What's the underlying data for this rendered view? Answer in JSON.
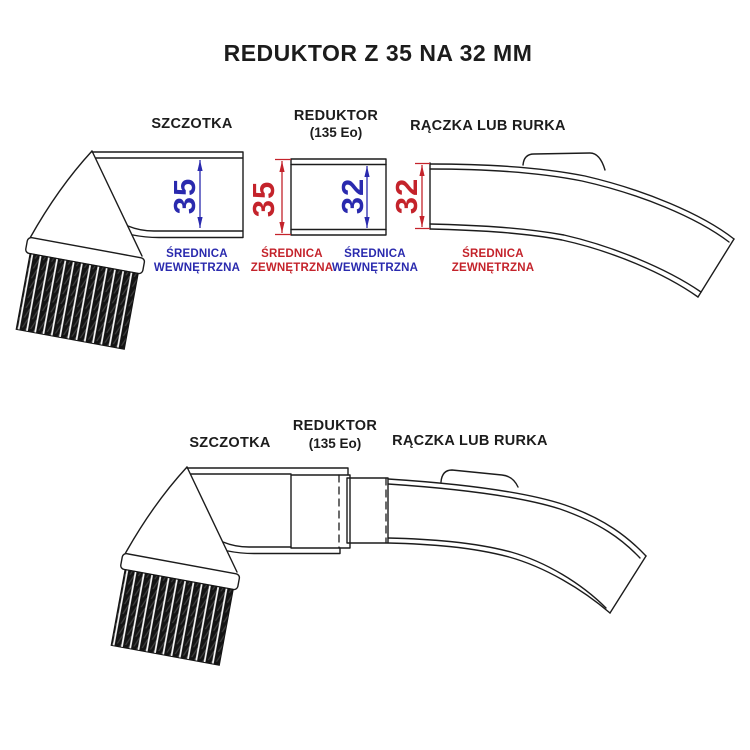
{
  "title": "REDUKTOR Z 35 NA 32 MM",
  "colors": {
    "line_color": "#1c1c1c",
    "inner_dim_color": "#2a2aae",
    "outer_dim_color": "#c4232b",
    "background": "#ffffff"
  },
  "exploded_view": {
    "szczotka_label": "SZCZOTKA",
    "reduktor_label": "REDUKTOR",
    "reduktor_sub_label": "(135 Eo)",
    "raczka_label": "RĄCZKA LUB RURKA",
    "dims": [
      {
        "value": "35",
        "type": "inner",
        "label_line1": "ŚREDNICA",
        "label_line2": "WEWNĘTRZNA"
      },
      {
        "value": "35",
        "type": "outer",
        "label_line1": "ŚREDNICA",
        "label_line2": "ZEWNĘTRZNA"
      },
      {
        "value": "32",
        "type": "inner",
        "label_line1": "ŚREDNICA",
        "label_line2": "WEWNĘTRZNA"
      },
      {
        "value": "32",
        "type": "outer",
        "label_line1": "ŚREDNICA",
        "label_line2": "ZEWNĘTRZNA"
      }
    ]
  },
  "assembled_view": {
    "szczotka_label": "SZCZOTKA",
    "reduktor_label": "REDUKTOR",
    "reduktor_sub_label": "(135 Eo)",
    "raczka_label": "RĄCZKA LUB RURKA"
  }
}
